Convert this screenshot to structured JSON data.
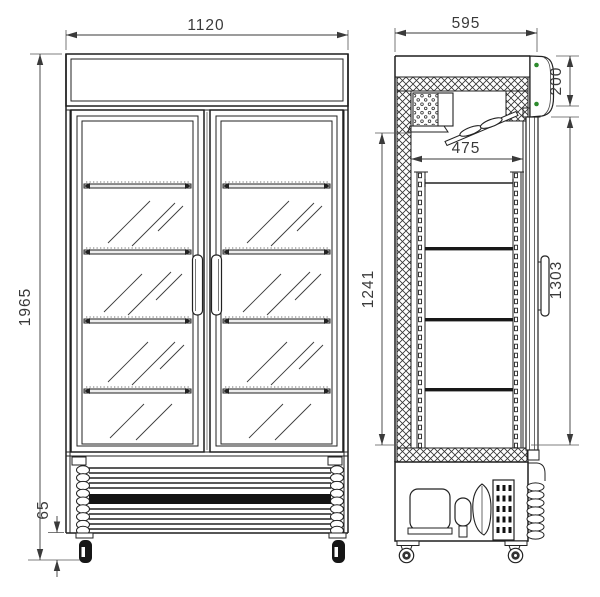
{
  "dimensions": {
    "front_width": "1120",
    "front_total_height": "1965",
    "caster_base_height": "65",
    "side_depth": "595",
    "header_height": "200",
    "interior_depth": "475",
    "interior_height": "1241",
    "door_height": "1303"
  },
  "colors": {
    "line": "#222222",
    "dim_text": "#3a3a3a",
    "indicator": "#2e8b2e"
  }
}
